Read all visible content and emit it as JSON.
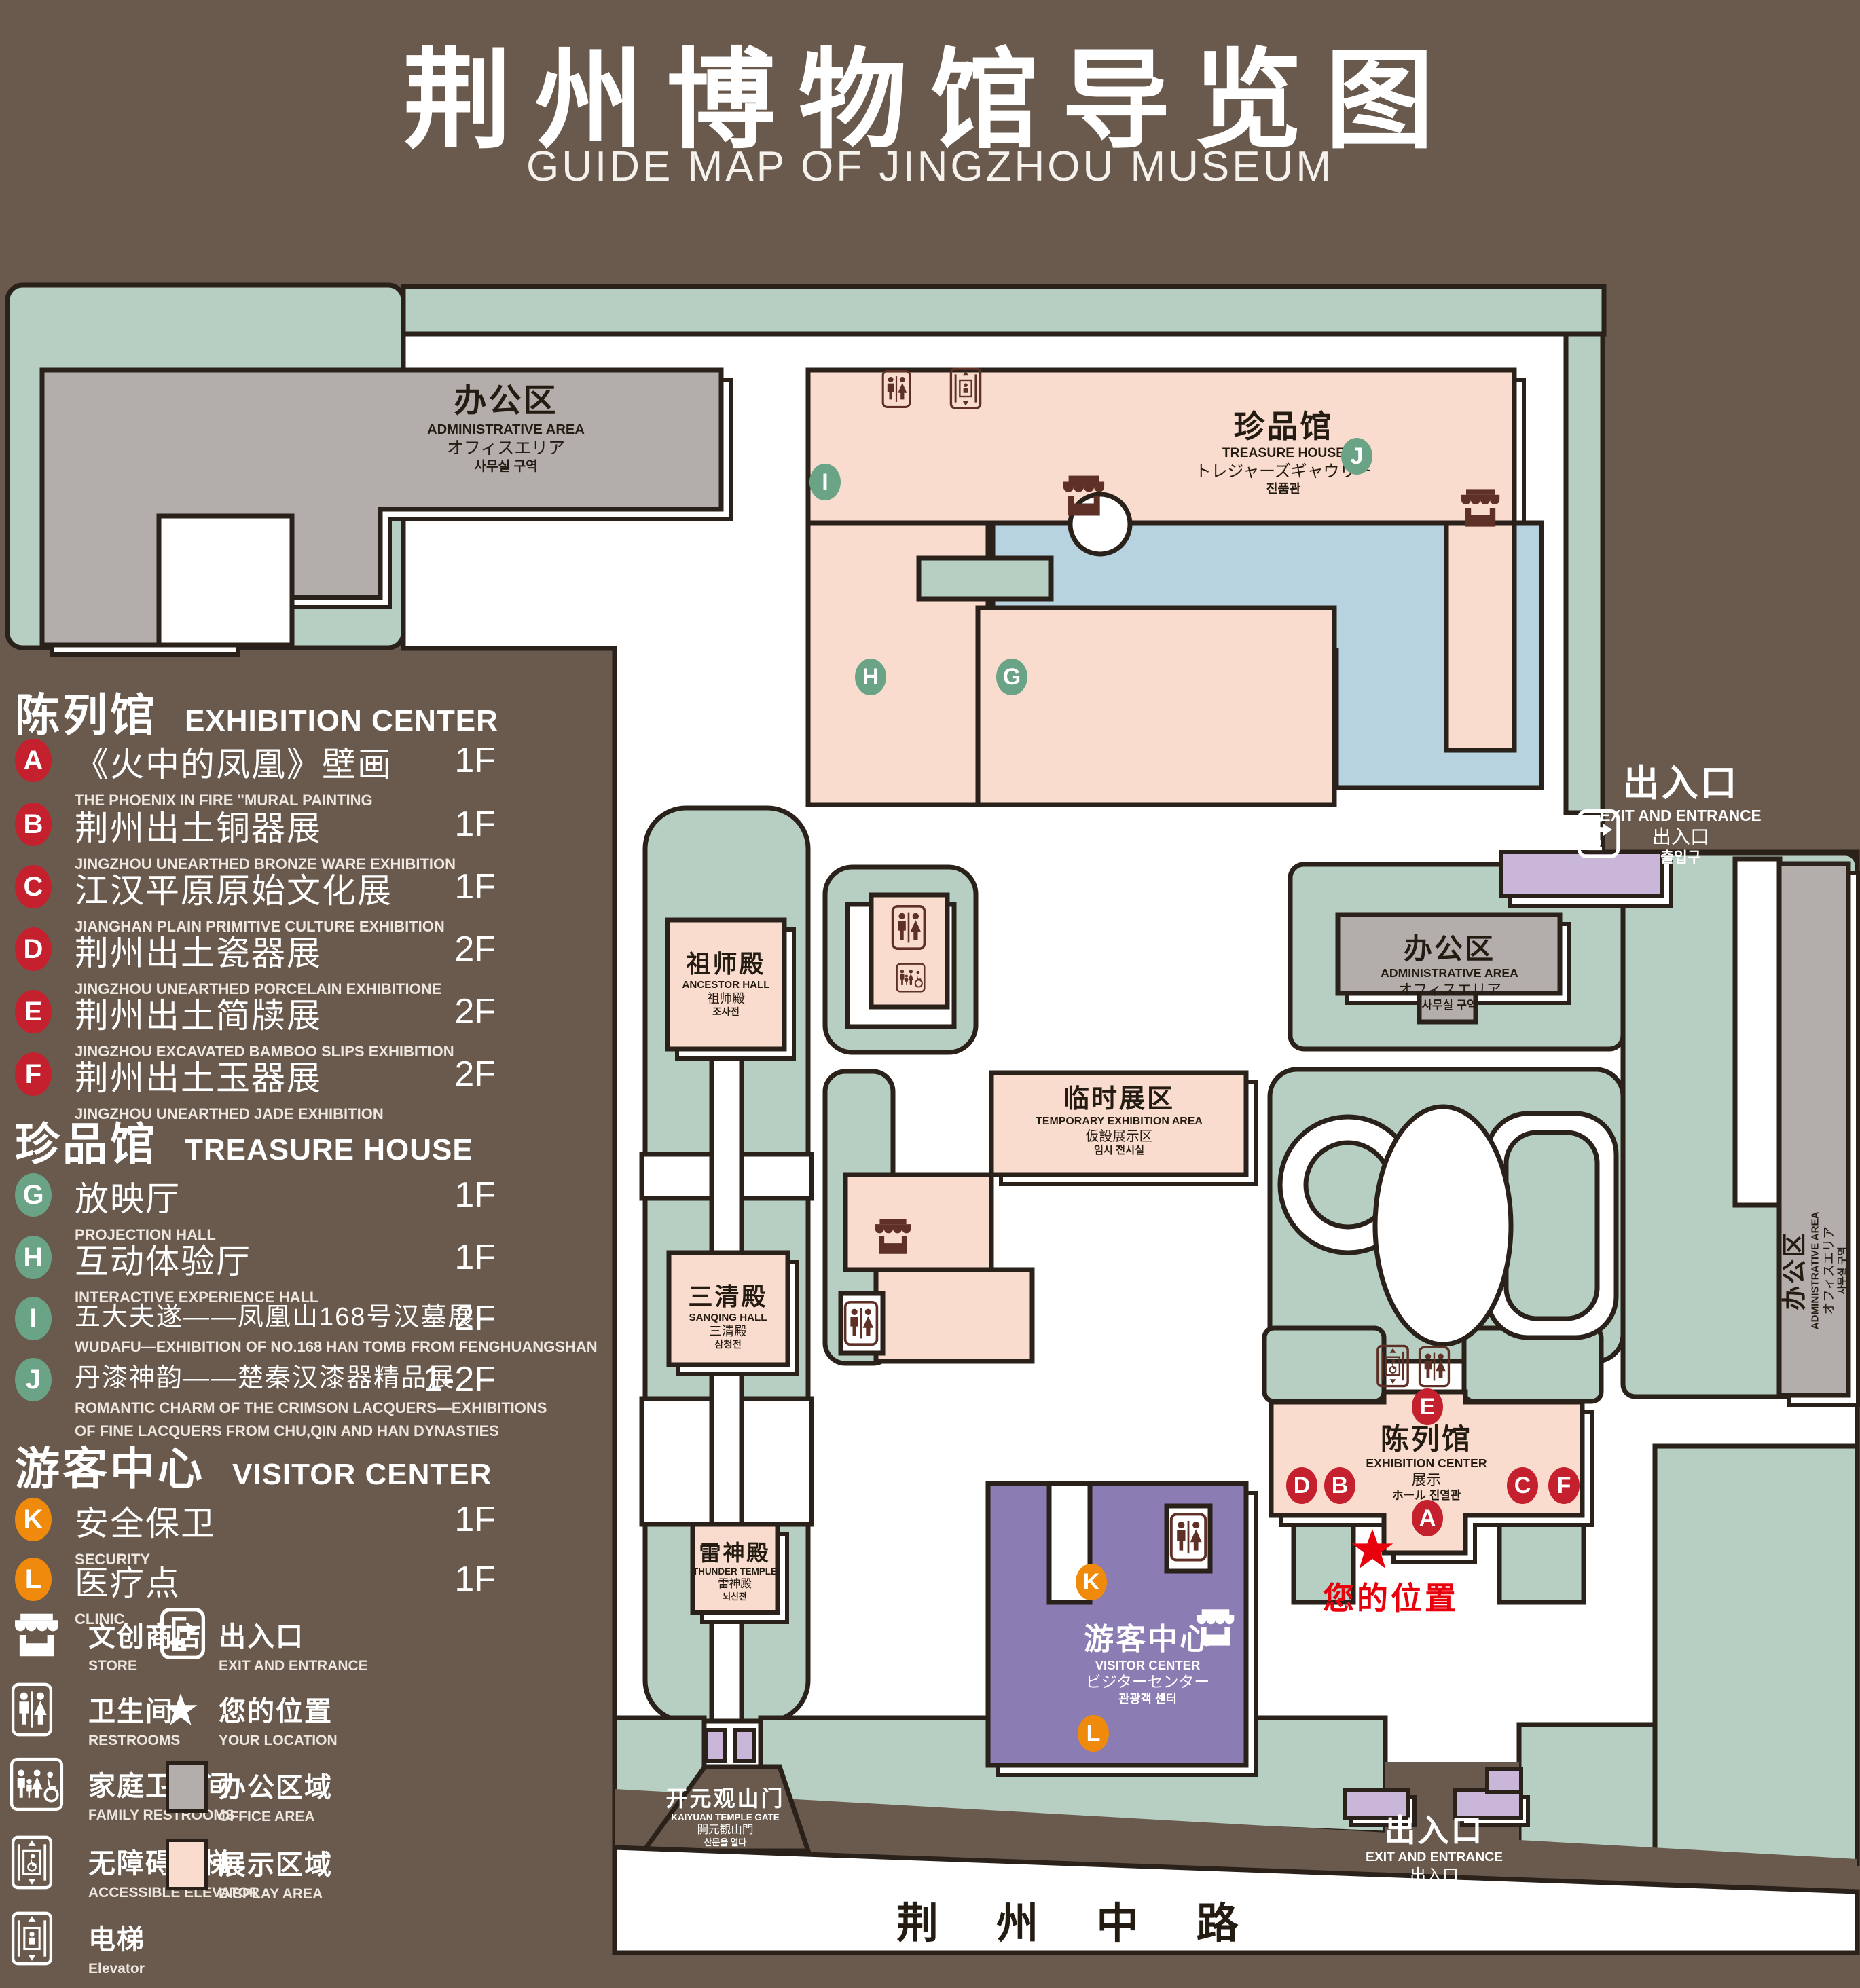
{
  "title": {
    "zh": "荆州博物馆导览图",
    "en": "GUIDE MAP OF JINGZHOU MUSEUM"
  },
  "colors": {
    "background": "#695a4d",
    "lawn": "#b6cfc2",
    "display_area": "#f9dcce",
    "office_area": "#b3aeab",
    "visitor_center": "#8b7cb4",
    "gate_purple": "#c9b6d8",
    "lake": "#b7d3e0",
    "marker_red": "#c5202e",
    "marker_green": "#6ba387",
    "marker_orange": "#f08a0c",
    "location_red": "#e8000d"
  },
  "legend": {
    "sec1": {
      "zh": "陈列馆",
      "en": "EXHIBITION CENTER"
    },
    "sec2": {
      "zh": "珍品馆",
      "en": "TREASURE HOUSE"
    },
    "sec3": {
      "zh": "游客中心",
      "en": "VISITOR CENTER"
    },
    "items": {
      "A": {
        "id": "A",
        "zh": "《火中的凤凰》壁画",
        "en": "THE PHOENIX IN FIRE \"MURAL PAINTING",
        "fl": "1F"
      },
      "B": {
        "id": "B",
        "zh": "荆州出土铜器展",
        "en": "JINGZHOU UNEARTHED BRONZE WARE EXHIBITION",
        "fl": "1F"
      },
      "C": {
        "id": "C",
        "zh": "江汉平原原始文化展",
        "en": "JIANGHAN PLAIN PRIMITIVE CULTURE EXHIBITION",
        "fl": "1F"
      },
      "D": {
        "id": "D",
        "zh": "荆州出土瓷器展",
        "en": "JINGZHOU UNEARTHED PORCELAIN EXHIBITIONE",
        "fl": "2F"
      },
      "E": {
        "id": "E",
        "zh": "荆州出土简牍展",
        "en": "JINGZHOU EXCAVATED BAMBOO SLIPS EXHIBITION",
        "fl": "2F"
      },
      "F": {
        "id": "F",
        "zh": "荆州出土玉器展",
        "en": "JINGZHOU UNEARTHED JADE EXHIBITION",
        "fl": "2F"
      },
      "G": {
        "id": "G",
        "zh": "放映厅",
        "en": "PROJECTION HALL",
        "fl": "1F"
      },
      "H": {
        "id": "H",
        "zh": "互动体验厅",
        "en": "INTERACTIVE EXPERIENCE HALL",
        "fl": "1F"
      },
      "I": {
        "id": "I",
        "zh": "五大夫遂——凤凰山168号汉墓展",
        "en": "WUDAFU—EXHIBITION OF NO.168 HAN TOMB FROM FENGHUANGSHAN",
        "fl": "2F"
      },
      "J": {
        "id": "J",
        "zh": "丹漆神韵——楚秦汉漆器精品展",
        "en": "ROMANTIC CHARM OF THE CRIMSON LACQUERS—EXHIBITIONS",
        "en2": "OF FINE LACQUERS FROM CHU,QIN AND HAN DYNASTIES",
        "fl": "1-2F"
      },
      "K": {
        "id": "K",
        "zh": "安全保卫",
        "en": "SECURITY",
        "fl": "1F"
      },
      "L": {
        "id": "L",
        "zh": "医疗点",
        "en": "CLINIC",
        "fl": "1F"
      }
    },
    "symbols": {
      "store": {
        "zh": "文创商店",
        "en": "STORE"
      },
      "exit": {
        "zh": "出入口",
        "en": "EXIT AND ENTRANCE"
      },
      "restrooms": {
        "zh": "卫生间",
        "en": "RESTROOMS"
      },
      "location": {
        "zh": "您的位置",
        "en": "YOUR LOCATION"
      },
      "family": {
        "zh": "家庭卫生间",
        "en": "FAMILY RESTROOMS"
      },
      "office": {
        "zh": "办公区域",
        "en": "OFFICE AREA"
      },
      "accessible": {
        "zh": "无障碍电梯",
        "en": "ACCESSIBLE ELEVATOR"
      },
      "display": {
        "zh": "展示区域",
        "en": "DISPLAY AREA"
      },
      "elevator": {
        "zh": "电梯",
        "en": "Elevator"
      }
    }
  },
  "map": {
    "admin": {
      "zh": "办公区",
      "en": "ADMINISTRATIVE AREA",
      "ja": "オフィスエリア",
      "ko": "사무실 구역"
    },
    "treasure": {
      "zh": "珍品馆",
      "en": "TREASURE HOUSE",
      "ja": "トレジャーズギャウリー",
      "ko": "진품관"
    },
    "ancestor": {
      "zh": "祖师殿",
      "en": "ANCESTOR HALL",
      "ja": "祖师殿",
      "ko": "조사전"
    },
    "temp": {
      "zh": "临时展区",
      "en": "TEMPORARY EXHIBITION AREA",
      "ja": "仮設展示区",
      "ko": "임시 전시실"
    },
    "sanqing": {
      "zh": "三清殿",
      "en": "SANQING HALL",
      "ja": "三清殿",
      "ko": "삼청전"
    },
    "thunder": {
      "zh": "雷神殿",
      "en": "THUNDER TEMPLE",
      "ja": "雷神殿",
      "ko": "뇌신전"
    },
    "visitor": {
      "zh": "游客中心",
      "en": "VISITOR CENTER",
      "ja": "ビジターセンター",
      "ko": "관광객 센터"
    },
    "exhibition": {
      "zh": "陈列馆",
      "en": "EXHIBITION CENTER",
      "ja": "展示",
      "ko": "ホール 진열관"
    },
    "gate": {
      "zh": "开元观山门",
      "en": "KAIYUAN TEMPLE GATE",
      "ja": "開元観山門",
      "ko": "산문을 열다"
    },
    "exit_ne": {
      "zh": "出入口",
      "en": "EXIT AND ENTRANCE",
      "zh2": "出入口",
      "ko": "출입구"
    },
    "exit_s": {
      "zh": "出入口",
      "en": "EXIT AND ENTRANCE",
      "zh2": "出入口",
      "ko": "출입구"
    },
    "road": "荆 州 中 路",
    "you": "您的位置",
    "markers": {
      "A": "A",
      "B": "B",
      "C": "C",
      "D": "D",
      "E": "E",
      "F": "F",
      "G": "G",
      "H": "H",
      "I": "I",
      "J": "J",
      "K": "K",
      "L": "L"
    }
  }
}
